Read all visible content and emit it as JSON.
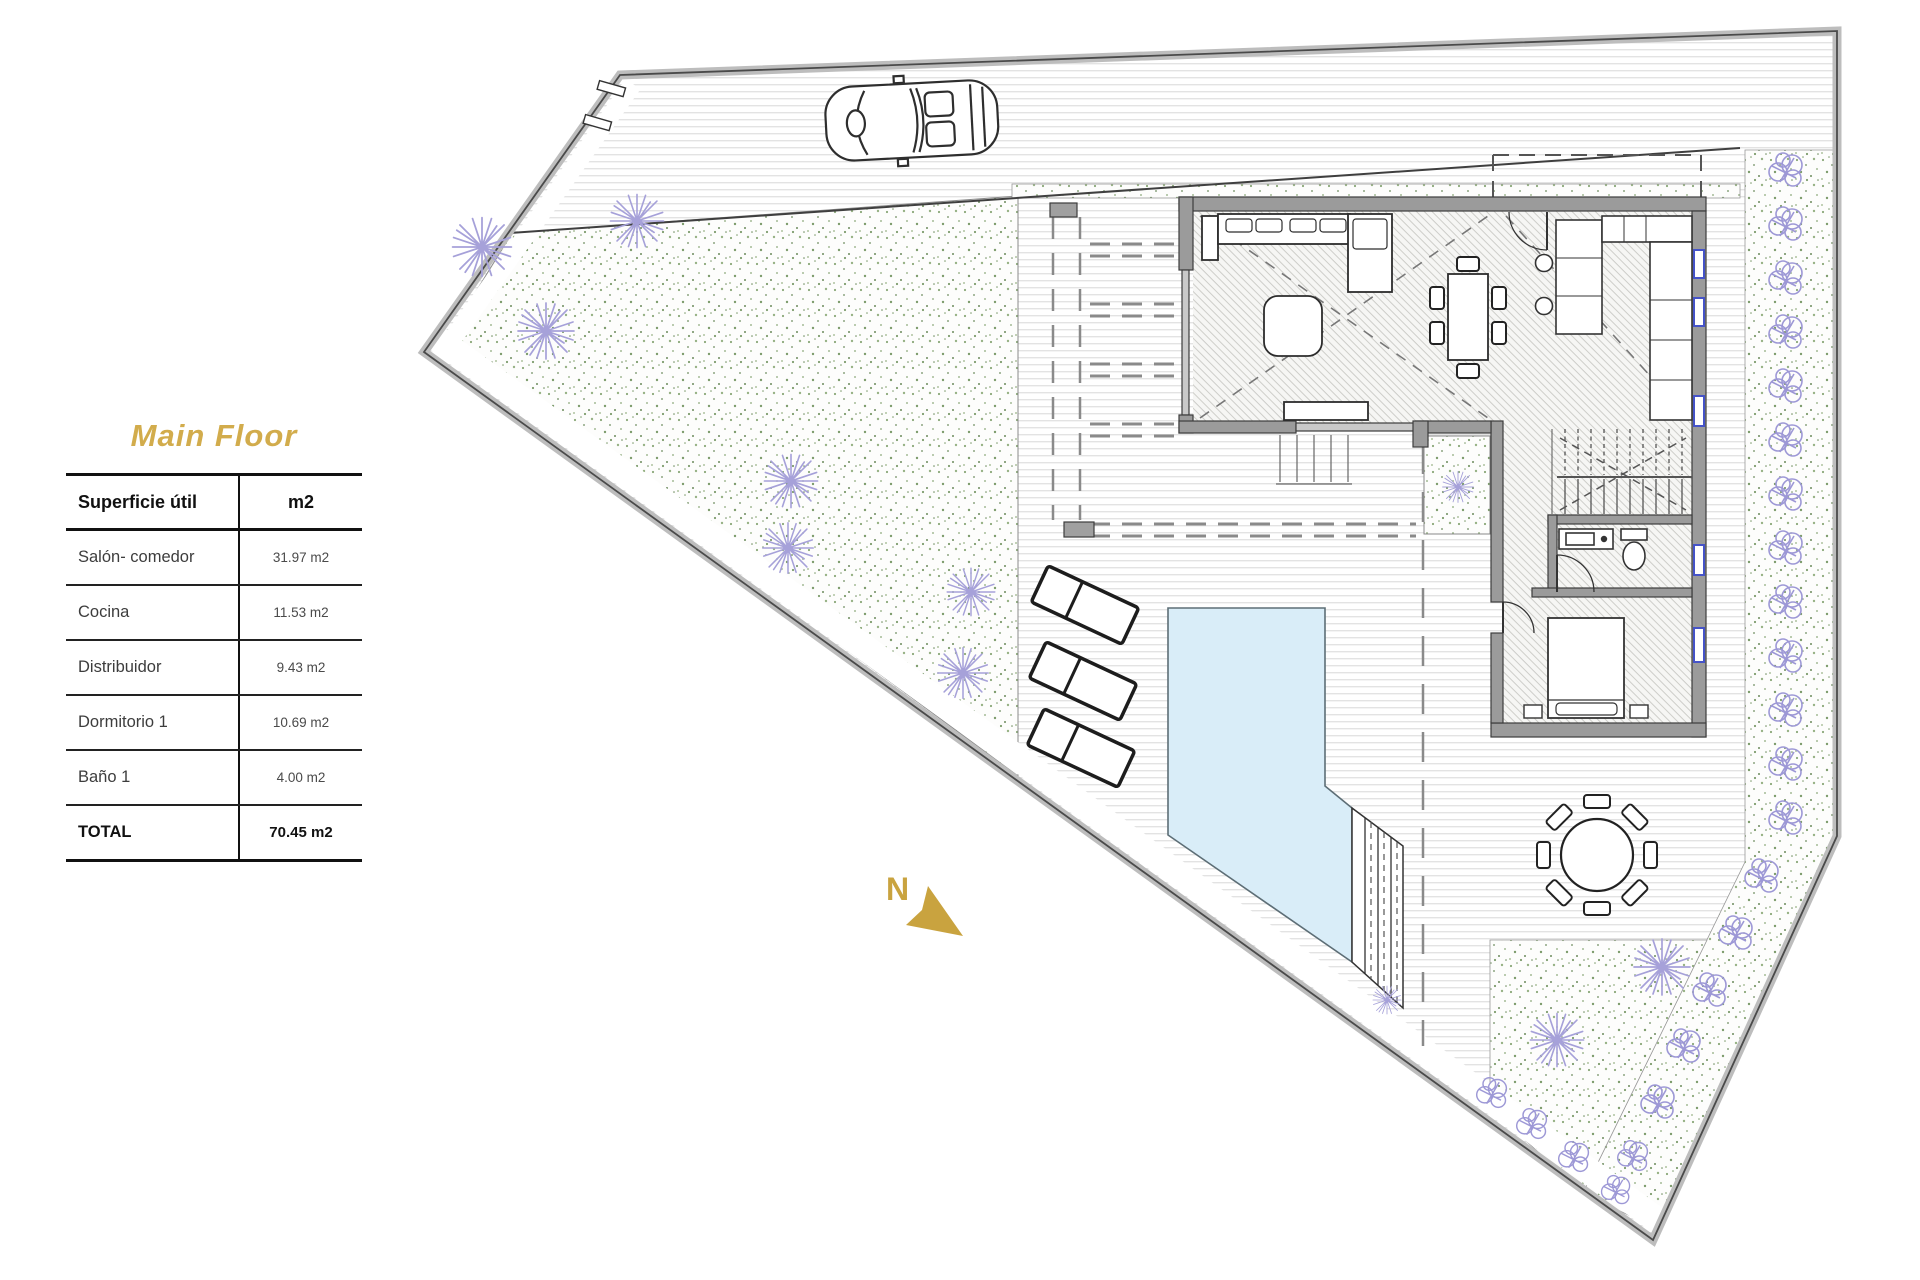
{
  "page": {
    "title_label": "Main Floor"
  },
  "area_table": {
    "header": {
      "label": "Superficie útil",
      "unit": "m2"
    },
    "rows": [
      {
        "label": "Salón- comedor",
        "value": "31.97 m2"
      },
      {
        "label": "Cocina",
        "value": "11.53 m2"
      },
      {
        "label": "Distribuidor",
        "value": "9.43 m2"
      },
      {
        "label": "Dormitorio 1",
        "value": "10.69 m2"
      },
      {
        "label": "Baño 1",
        "value": "4.00 m2"
      }
    ],
    "total": {
      "label": "TOTAL",
      "value": "70.45 m2"
    }
  },
  "plan": {
    "north_label": "N",
    "colors": {
      "accent_gold": "#d2ac4c",
      "north_arrow_gold": "#c9a33f",
      "pool_water": "#d9edf8",
      "garden_speckle_green": "#7d9c6c",
      "vegetation_violet": "#a6a1d9",
      "wall_gray": "#9b9b9b"
    },
    "features": [
      "site-boundary",
      "driveway",
      "garden",
      "hedge",
      "house",
      "pergola",
      "pool",
      "pool-steps",
      "sun-loungers",
      "outdoor-dining-table",
      "car",
      "north-arrow",
      "trees",
      "bushes",
      "stairs",
      "bathroom",
      "bedroom",
      "kitchen",
      "living-room"
    ]
  }
}
